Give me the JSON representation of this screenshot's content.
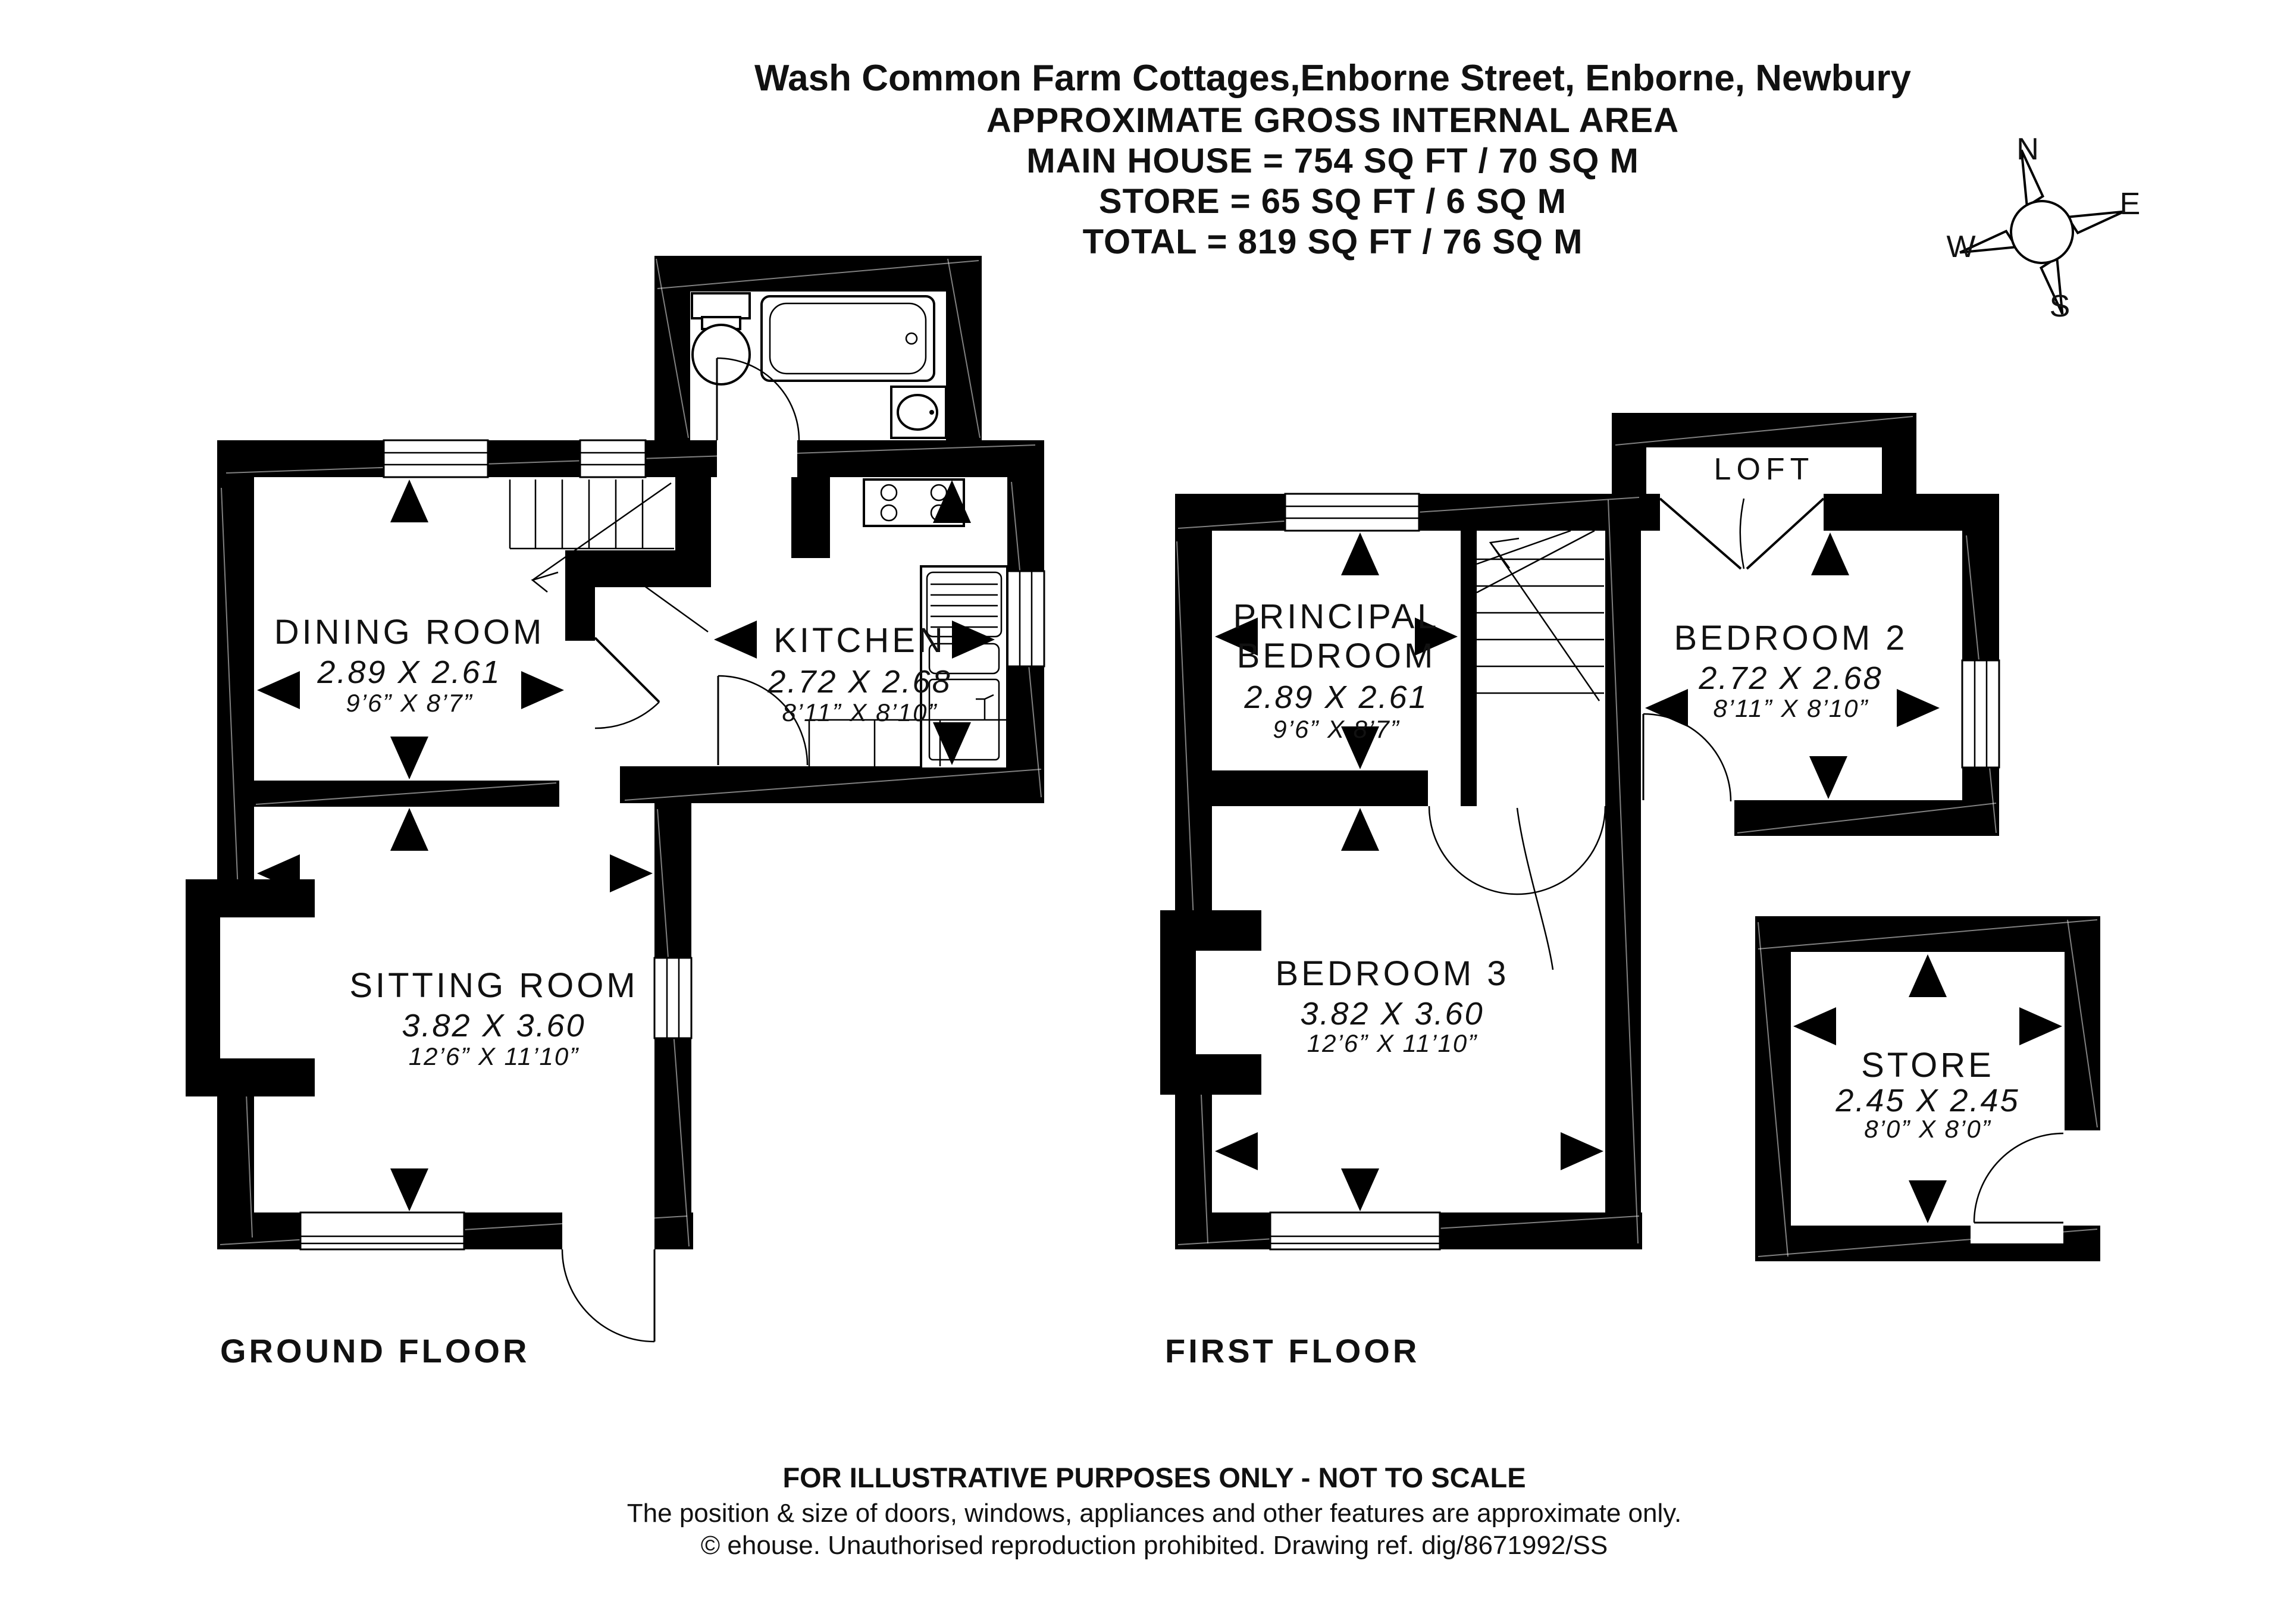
{
  "title": {
    "address": "Wash Common Farm Cottages,Enborne Street, Enborne, Newbury",
    "line2": "APPROXIMATE GROSS INTERNAL AREA",
    "line3": "MAIN HOUSE = 754 SQ FT / 70 SQ M",
    "line4": "STORE = 65 SQ FT / 6 SQ M",
    "line5": "TOTAL = 819 SQ FT / 76 SQ M"
  },
  "compass": {
    "north": "N",
    "east": "E",
    "south": "S",
    "west": "W"
  },
  "ground_floor": {
    "label": "GROUND FLOOR",
    "rooms": {
      "dining": {
        "name": "DINING ROOM",
        "metric": "2.89 X 2.61",
        "imperial": "9’6” X 8’7”"
      },
      "kitchen": {
        "name": "KITCHEN",
        "metric": "2.72 X 2.68",
        "imperial": "8’11” X 8’10”"
      },
      "sitting": {
        "name": "SITTING ROOM",
        "metric": "3.82 X 3.60",
        "imperial": "12’6” X 11’10”"
      }
    }
  },
  "first_floor": {
    "label": "FIRST FLOOR",
    "rooms": {
      "principal": {
        "name_line1": "PRINCIPAL",
        "name_line2": "BEDROOM",
        "metric": "2.89 X 2.61",
        "imperial": "9’6” X 8’7”"
      },
      "bedroom2": {
        "name": "BEDROOM 2",
        "metric": "2.72 X 2.68",
        "imperial": "8’11” X 8’10”"
      },
      "bedroom3": {
        "name": "BEDROOM 3",
        "metric": "3.82 X 3.60",
        "imperial": "12’6” X 11’10”"
      },
      "loft": {
        "name": "LOFT"
      },
      "store": {
        "name": "STORE",
        "metric": "2.45 X 2.45",
        "imperial": "8’0” X 8’0”"
      }
    }
  },
  "footer": {
    "line1": "FOR ILLUSTRATIVE PURPOSES ONLY - NOT TO SCALE",
    "line2": "The position & size of doors, windows, appliances and other features are approximate only.",
    "line3": "© ehouse. Unauthorised reproduction prohibited. Drawing ref. dig/8671992/SS"
  },
  "colors": {
    "wall": "#000000",
    "label_gray": "#8e8e8e",
    "text": "#111111"
  }
}
